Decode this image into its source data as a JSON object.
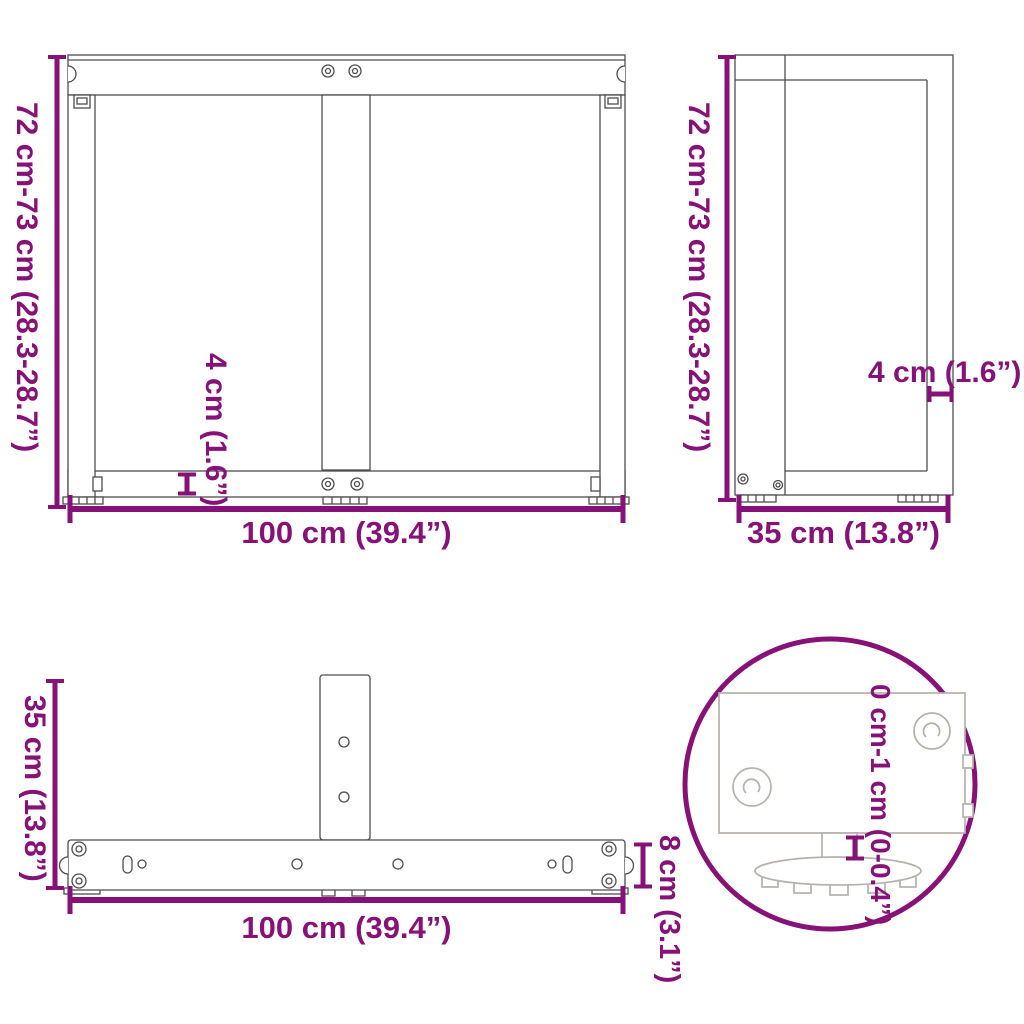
{
  "colors": {
    "accent_purple": "#871277",
    "drawing_line": "#4d4d4d",
    "detail_drawing_line": "#b5b1ae",
    "background": "#ffffff"
  },
  "views": {
    "front": {
      "height": "72 cm-73 cm (28.3-28.7”)",
      "width": "100 cm (39.4”)",
      "bottom_bar_thickness": "4 cm (1.6”)"
    },
    "side": {
      "height": "72 cm-73 cm (28.3-28.7”)",
      "depth": "35 cm (13.8”)",
      "plate_thickness": "4 cm (1.6”)"
    },
    "top": {
      "depth": "35 cm (13.8”)",
      "width": "100 cm (39.4”)",
      "bar_width": "8 cm (3.1”)"
    },
    "foot_detail": {
      "adjustment_range": "0 cm-1 cm (0-0.4”)"
    }
  }
}
